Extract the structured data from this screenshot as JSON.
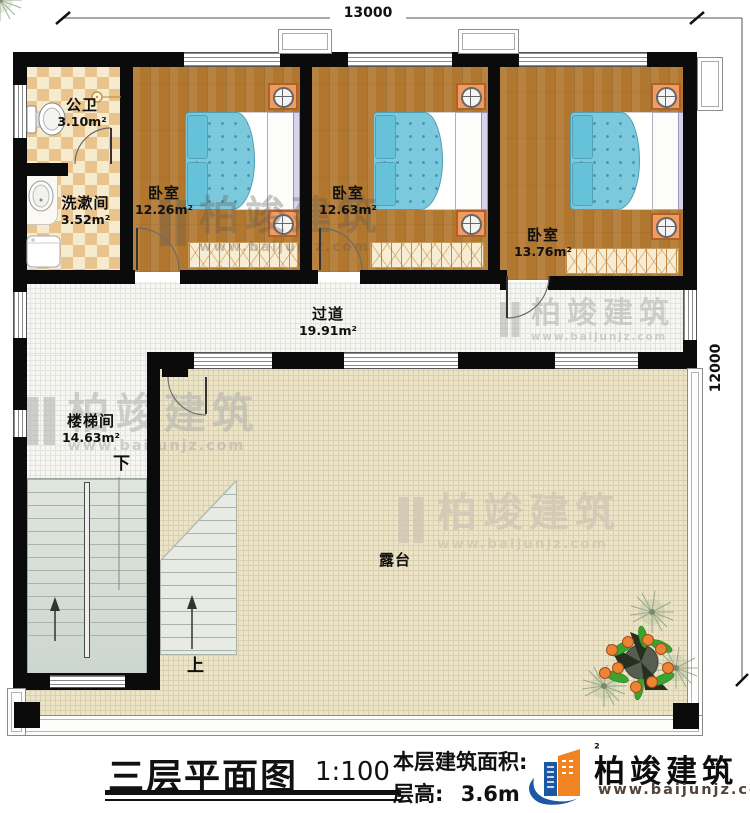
{
  "dimensions": {
    "width_top": "13000",
    "height_right": "12000"
  },
  "rooms": {
    "public_bath": {
      "name": "公卫",
      "area": "3.10m²"
    },
    "washroom": {
      "name": "洗漱间",
      "area": "3.52m²"
    },
    "bedroom1": {
      "name": "卧室",
      "area": "12.26m²"
    },
    "bedroom2": {
      "name": "卧室",
      "area": "12.63m²"
    },
    "bedroom3": {
      "name": "卧室",
      "area": "13.76m²"
    },
    "corridor": {
      "name": "过道",
      "area": "19.91m²"
    },
    "stairwell": {
      "name": "楼梯间",
      "area": "14.63m²"
    },
    "terrace": {
      "name": "露台"
    }
  },
  "stairs": {
    "down_label": "下",
    "up_label": "上"
  },
  "title_block": {
    "title": "三层平面图",
    "scale": "1:100",
    "floor_area_label": "本层建筑面积:",
    "floor_area_sup": "²",
    "floor_height_label": "层高:",
    "floor_height_value": "3.6m"
  },
  "logo": {
    "name": "柏竣建筑",
    "website": "www.baijunjz.com"
  },
  "watermark": {
    "text": "柏竣建筑",
    "subtext": "www.baijunjz.com"
  },
  "colors": {
    "wall": "#0b0b0b",
    "wood_floor": "#b1772f",
    "checker_dark": "#e9c48c",
    "checker_light": "#f7ebcf",
    "bed_blue": "#7cc8dc",
    "corridor_floor": "#f6f6f3",
    "terrace_floor": "#ece4c9",
    "nightstand_orange": "#ef9c61",
    "logo_blue": "#1c57a5",
    "logo_orange": "#f08421"
  }
}
